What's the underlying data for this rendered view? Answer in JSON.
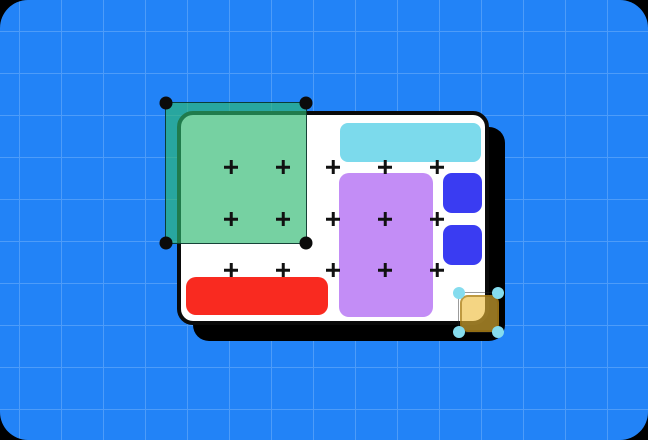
{
  "scene": {
    "type": "design-canvas-illustration",
    "background": {
      "color": "#2283F7",
      "grid_line_color": "#4D9CF9",
      "grid_size_px": 42,
      "grid_offset_x": 19,
      "grid_offset_y": 31,
      "page_corner_color": "#000000"
    },
    "artboard": {
      "fill": "#FFFFFF",
      "border_color": "#0A0A0A",
      "shadow_color": "#000000"
    },
    "shapes": [
      {
        "name": "selected-green-rectangle",
        "fill": "rgba(44,185,112,0.65)",
        "stroke": "rgba(6,42,38,0.85)",
        "handle_color": "#0B0B0B",
        "selected": true
      },
      {
        "name": "cyan-bar",
        "fill": "#7CDAEC",
        "selected": false
      },
      {
        "name": "purple-rectangle",
        "fill": "#C38DF6",
        "selected": false
      },
      {
        "name": "blue-square-top",
        "fill": "#3A3CF2",
        "selected": false
      },
      {
        "name": "blue-square-bottom",
        "fill": "#3A3CF2",
        "selected": false
      },
      {
        "name": "red-bar",
        "fill": "#F92A20",
        "selected": false
      },
      {
        "name": "selected-yellow-square",
        "fill": "rgba(238,188,55,0.62)",
        "stroke": "rgba(146,104,10,0.55)",
        "outline": "rgba(35,35,35,0.45)",
        "handle_color": "#85DCEE",
        "selected": true
      }
    ],
    "snap_points": {
      "color": "#111111",
      "cols": [
        231,
        283,
        333,
        385,
        437
      ],
      "rows": [
        167,
        219,
        270
      ]
    }
  }
}
